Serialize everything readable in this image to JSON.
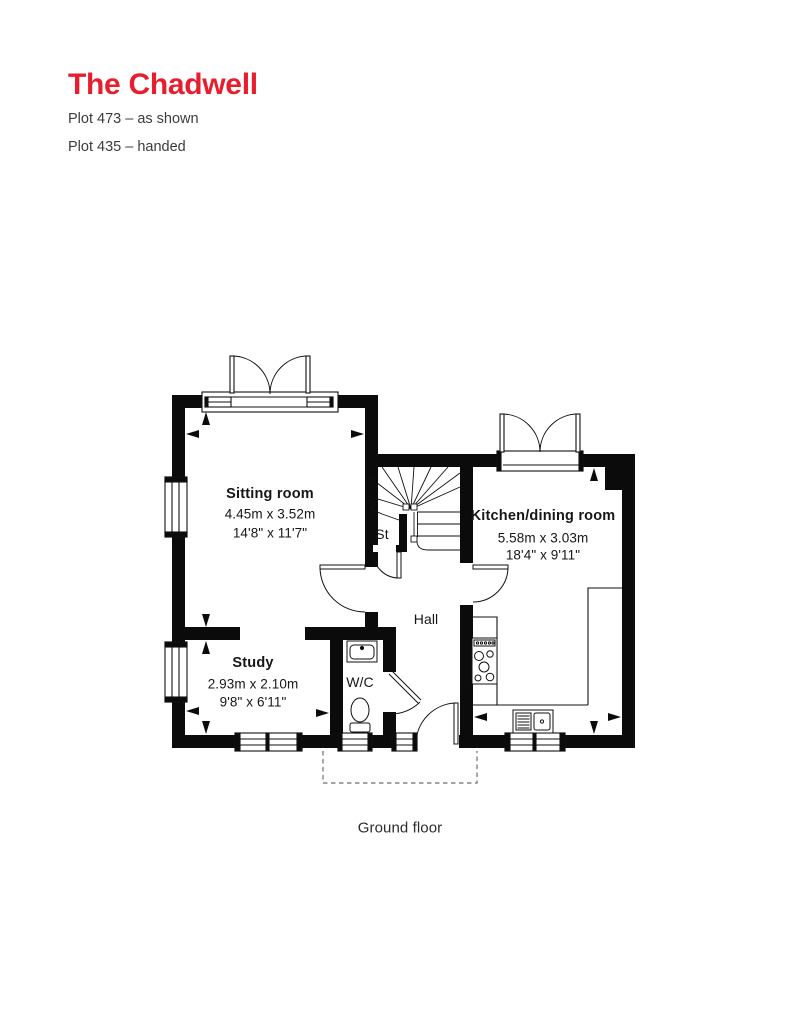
{
  "header": {
    "title": "The Chadwell",
    "title_color": "#e61e2e",
    "plot_lines": [
      "Plot 473 – as shown",
      "Plot 435 – handed"
    ]
  },
  "plan": {
    "caption": "Ground floor",
    "wall_color": "#0b0b0b",
    "rooms": {
      "sitting": {
        "name": "Sitting room",
        "metric": "4.45m x 3.52m",
        "imperial": "14'8\" x 11'7\""
      },
      "study": {
        "name": "Study",
        "metric": "2.93m x 2.10m",
        "imperial": "9'8\" x 6'11\""
      },
      "kitchen": {
        "name": "Kitchen/dining room",
        "metric": "5.58m x 3.03m",
        "imperial": "18'4\" x 9'11\""
      },
      "hall": {
        "name": "Hall"
      },
      "storage": {
        "name": "St"
      },
      "wc": {
        "name": "W/C"
      }
    }
  }
}
